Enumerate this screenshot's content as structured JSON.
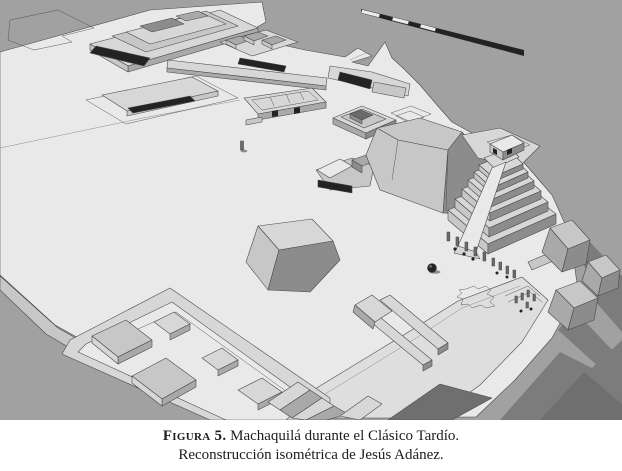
{
  "figure": {
    "caption_label": "Figura 5.",
    "caption_title": "Machaquilá durante el Clásico Tardío.",
    "caption_credit": "Reconstrucción isométrica de Jesús Adánez."
  },
  "scene": {
    "site_name": "Machaquilá",
    "period": "Clásico Tardío",
    "view": "isometric architectural reconstruction, grayscale 3D model",
    "features": [
      "main plaza",
      "north acropolis platform",
      "room cluster",
      "causeway",
      "range building with dark roof",
      "long palace with interior rooms",
      "tiered platform",
      "central shrine with dark doorway",
      "plain stela",
      "natural hill with summit plan outline",
      "stepped pyramid with stairway",
      "rows of stelae and altars",
      "spherical altar",
      "quatrefoil plaza outline",
      "south terrace with long low platforms",
      "southwest quadrangle group",
      "east terrace mounds with cast shadows",
      "isometric scale bar"
    ]
  },
  "colors": {
    "page_bg": "#ffffff",
    "terrain_bg": "#a1a1a1",
    "terrain_shadow": "#7c7c7c",
    "terrain_shadow_dark": "#6f6f6f",
    "plaza": "#e9e9e9",
    "plaza_low": "#dedede",
    "terrace_top": "#d7d7d7",
    "face_light": "#c7c7c7",
    "face_mid": "#a9a9a9",
    "face_dark": "#8c8c8c",
    "roof_dark": "#232323",
    "marker_gray": "#6b6b6b",
    "segment_white": "#ececec",
    "line": "#4a4a4a",
    "caption_text": "#1d1d1b"
  }
}
